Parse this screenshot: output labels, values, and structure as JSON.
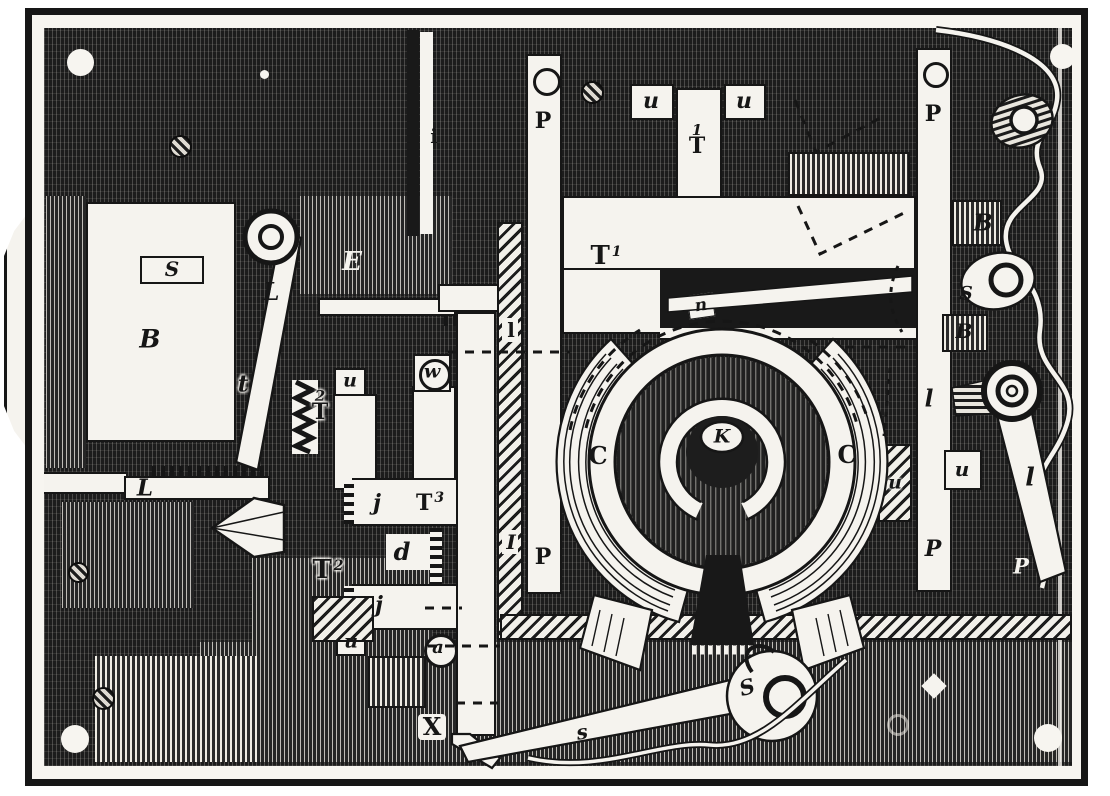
{
  "figure": {
    "colors": {
      "ink": "#161616",
      "paper": "#f5f3ee",
      "plate": "#1c1c1c"
    },
    "labels": {
      "pillar_left_top_p": "P",
      "pillar_left_bottom_p": "P",
      "top_u_left": "u",
      "top_u_right": "u",
      "top_t_sup": "1",
      "top_t_base": "T",
      "slot_i": "i",
      "frame_e": "E",
      "magnet_s": "S",
      "magnet_b": "B",
      "lever_l": "L",
      "lever_t": "t",
      "t2_upper_sup": "2",
      "t2_upper_base": "T",
      "u_mid": "u",
      "w_roller": "w",
      "j_upper": "j",
      "t3_base": "T",
      "t3_sup": "3",
      "d_rack": "d",
      "t2_lower_base": "T",
      "t2_lower_sup": "2",
      "j_lower": "j",
      "u_boxed": "u",
      "a_roller": "a",
      "x_bar": "X",
      "l_bar": "L",
      "rail_top_l": "l",
      "rail_bottom_i": "I",
      "t1_base": "T",
      "t1_sup": "1",
      "n_pawl": "n",
      "c_left": "C",
      "k_hub": "K",
      "c_right": "C",
      "pillar_right_top_p": "P",
      "pillar_right_bottom_p": "P",
      "b_right_upper": "B",
      "s_right": "S",
      "b_right_lower": "B",
      "l_right_box": "l",
      "u_right_white": "u",
      "u_right_hatch": "u",
      "l_lever_right": "l",
      "p_right_italic": "P",
      "s_lever_bar": "s",
      "s_lever_head": "S"
    }
  }
}
